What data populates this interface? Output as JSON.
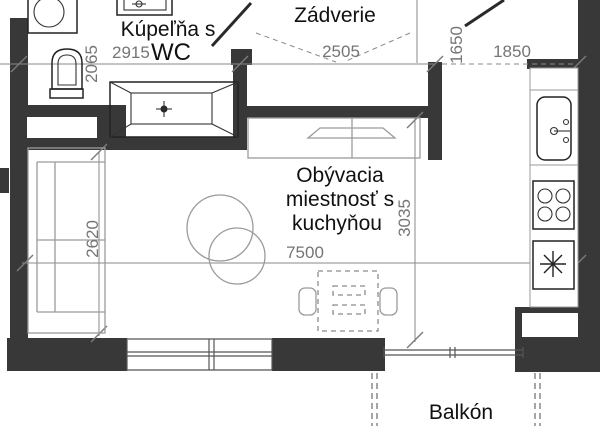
{
  "plan": {
    "type": "apartment-floor-plan",
    "colors": {
      "wall": "#383838",
      "fixture_line": "#222222",
      "furniture_line": "#9a9a9a",
      "dimension_line": "#8a8a8a",
      "label_text": "#111111",
      "dimension_text": "#757575",
      "background": "#ffffff"
    },
    "rooms": {
      "bathroom": {
        "label": "Kúpeľňa s",
        "label2": "WC",
        "width_mm": "2915",
        "depth_mm": "2065"
      },
      "hall": {
        "label": "Zádverie",
        "width_mm": "2505",
        "depth_mm": "1650"
      },
      "kitchen": {
        "width_mm": "1850"
      },
      "living": {
        "label_line1": "Obývacia",
        "label_line2": "miestnosť s",
        "label_line3": "kuchyňou",
        "width_mm": "7500",
        "depth_mm": "3035",
        "sofa_side_mm": "2620"
      },
      "balcony": {
        "label": "Balkón"
      }
    },
    "fixtures": [
      "washing-machine",
      "toilet",
      "washbasin",
      "bathtub",
      "kitchen-sink",
      "stove",
      "fridge",
      "sofa",
      "armchair",
      "dining-table",
      "tv-sideboard",
      "window",
      "balcony-door",
      "balcony-railing"
    ]
  }
}
